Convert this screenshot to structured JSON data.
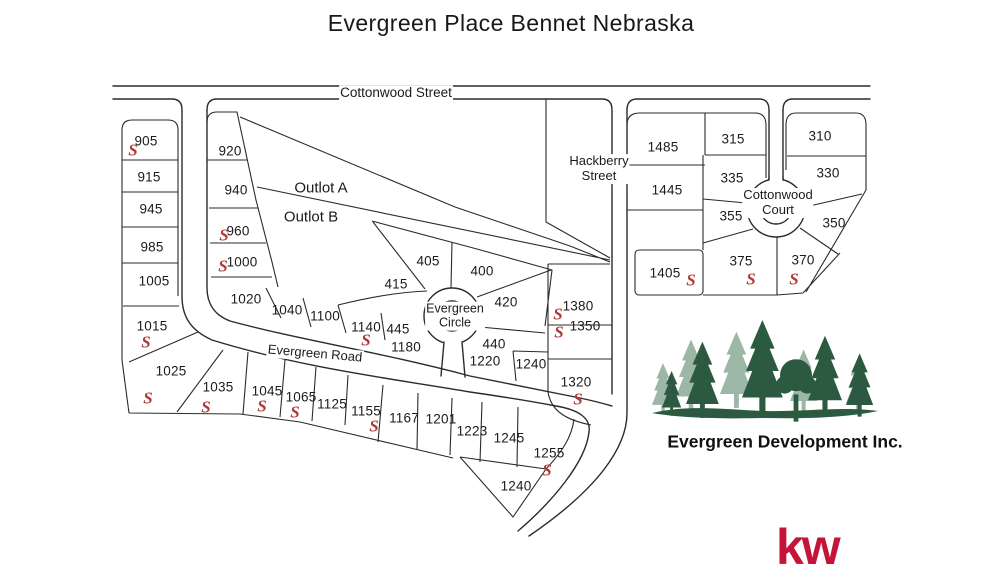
{
  "title": "Evergreen Place Bennet Nebraska",
  "map": {
    "sold_symbol": "S",
    "streets": [
      {
        "id": "cottonwood-street",
        "label": "Cottonwood Street",
        "x": 396,
        "y": 93,
        "rotate": 0,
        "size": 13.5,
        "two_line": false
      },
      {
        "id": "hackberry-street",
        "label": "Hackberry Street",
        "x": 599,
        "y": 169,
        "rotate": 0,
        "size": 13,
        "two_line": true
      },
      {
        "id": "cottonwood-court",
        "label": "Cottonwood Court",
        "x": 778,
        "y": 203,
        "rotate": 0,
        "size": 13,
        "two_line": true
      },
      {
        "id": "evergreen-road",
        "label": "Evergreen Road",
        "x": 315,
        "y": 354,
        "rotate": 5,
        "size": 13,
        "two_line": false
      },
      {
        "id": "evergreen-circle",
        "label": "Evergreen Circle",
        "x": 455,
        "y": 316,
        "rotate": 0,
        "size": 12.5,
        "two_line": true
      }
    ],
    "outlots": [
      {
        "id": "outlot-a",
        "label": "Outlot A",
        "x": 321,
        "y": 188
      },
      {
        "id": "outlot-b",
        "label": "Outlot B",
        "x": 311,
        "y": 217
      }
    ],
    "lots": [
      {
        "n": "905",
        "x": 146,
        "y": 141,
        "sx": 133,
        "sy": 150
      },
      {
        "n": "915",
        "x": 149,
        "y": 177
      },
      {
        "n": "945",
        "x": 151,
        "y": 209
      },
      {
        "n": "985",
        "x": 152,
        "y": 247
      },
      {
        "n": "1005",
        "x": 154,
        "y": 281
      },
      {
        "n": "1015",
        "x": 152,
        "y": 326,
        "sx": 146,
        "sy": 342
      },
      {
        "n": "1025",
        "x": 171,
        "y": 371,
        "sx": 148,
        "sy": 398
      },
      {
        "n": "1035",
        "x": 218,
        "y": 387,
        "sx": 206,
        "sy": 407
      },
      {
        "n": "1045",
        "x": 267,
        "y": 391,
        "sx": 262,
        "sy": 406
      },
      {
        "n": "1065",
        "x": 301,
        "y": 397,
        "sx": 295,
        "sy": 412
      },
      {
        "n": "1125",
        "x": 332,
        "y": 404
      },
      {
        "n": "1155",
        "x": 366,
        "y": 411,
        "sx": 374,
        "sy": 426
      },
      {
        "n": "1167",
        "x": 404,
        "y": 418
      },
      {
        "n": "1201",
        "x": 441,
        "y": 419
      },
      {
        "n": "1223",
        "x": 472,
        "y": 431
      },
      {
        "n": "1245",
        "x": 509,
        "y": 438
      },
      {
        "n": "1255",
        "x": 549,
        "y": 453,
        "sx": 547,
        "sy": 470
      },
      {
        "n": "1240",
        "x": 516,
        "y": 486
      },
      {
        "n": "920",
        "x": 230,
        "y": 151
      },
      {
        "n": "940",
        "x": 236,
        "y": 190
      },
      {
        "n": "960",
        "x": 238,
        "y": 231,
        "sx": 224,
        "sy": 235
      },
      {
        "n": "1000",
        "x": 242,
        "y": 262,
        "sx": 223,
        "sy": 266
      },
      {
        "n": "1020",
        "x": 246,
        "y": 299
      },
      {
        "n": "1040",
        "x": 287,
        "y": 310
      },
      {
        "n": "1100",
        "x": 325,
        "y": 316
      },
      {
        "n": "1140",
        "x": 366,
        "y": 327,
        "sx": 366,
        "sy": 340
      },
      {
        "n": "445",
        "x": 398,
        "y": 329
      },
      {
        "n": "1180",
        "x": 406,
        "y": 347
      },
      {
        "n": "405",
        "x": 428,
        "y": 261
      },
      {
        "n": "415",
        "x": 396,
        "y": 284
      },
      {
        "n": "400",
        "x": 482,
        "y": 271
      },
      {
        "n": "420",
        "x": 506,
        "y": 302
      },
      {
        "n": "440",
        "x": 494,
        "y": 344
      },
      {
        "n": "1220",
        "x": 485,
        "y": 361
      },
      {
        "n": "1240",
        "x": 531,
        "y": 364
      },
      {
        "n": "1380",
        "x": 578,
        "y": 306,
        "sx": 558,
        "sy": 314
      },
      {
        "n": "1350",
        "x": 585,
        "y": 326,
        "sx": 559,
        "sy": 332
      },
      {
        "n": "1320",
        "x": 576,
        "y": 382,
        "sx": 578,
        "sy": 399
      },
      {
        "n": "1405",
        "x": 665,
        "y": 273,
        "sx": 691,
        "sy": 280
      },
      {
        "n": "1485",
        "x": 663,
        "y": 147
      },
      {
        "n": "315",
        "x": 733,
        "y": 139
      },
      {
        "n": "310",
        "x": 820,
        "y": 136
      },
      {
        "n": "1445",
        "x": 667,
        "y": 190
      },
      {
        "n": "335",
        "x": 732,
        "y": 178
      },
      {
        "n": "330",
        "x": 828,
        "y": 173
      },
      {
        "n": "355",
        "x": 731,
        "y": 216
      },
      {
        "n": "350",
        "x": 834,
        "y": 223
      },
      {
        "n": "375",
        "x": 741,
        "y": 261,
        "sx": 751,
        "sy": 279
      },
      {
        "n": "370",
        "x": 803,
        "y": 260,
        "sx": 794,
        "sy": 279
      }
    ]
  },
  "logo": {
    "company": "Evergreen Development Inc.",
    "tree_dark": "#2c5a40",
    "tree_light": "#9cb7a6"
  },
  "brand": {
    "label": "kw",
    "color": "#c41539"
  },
  "colors": {
    "sold": "#b03a3a",
    "line": "#2b2b2b",
    "text": "#1b1b1b"
  }
}
